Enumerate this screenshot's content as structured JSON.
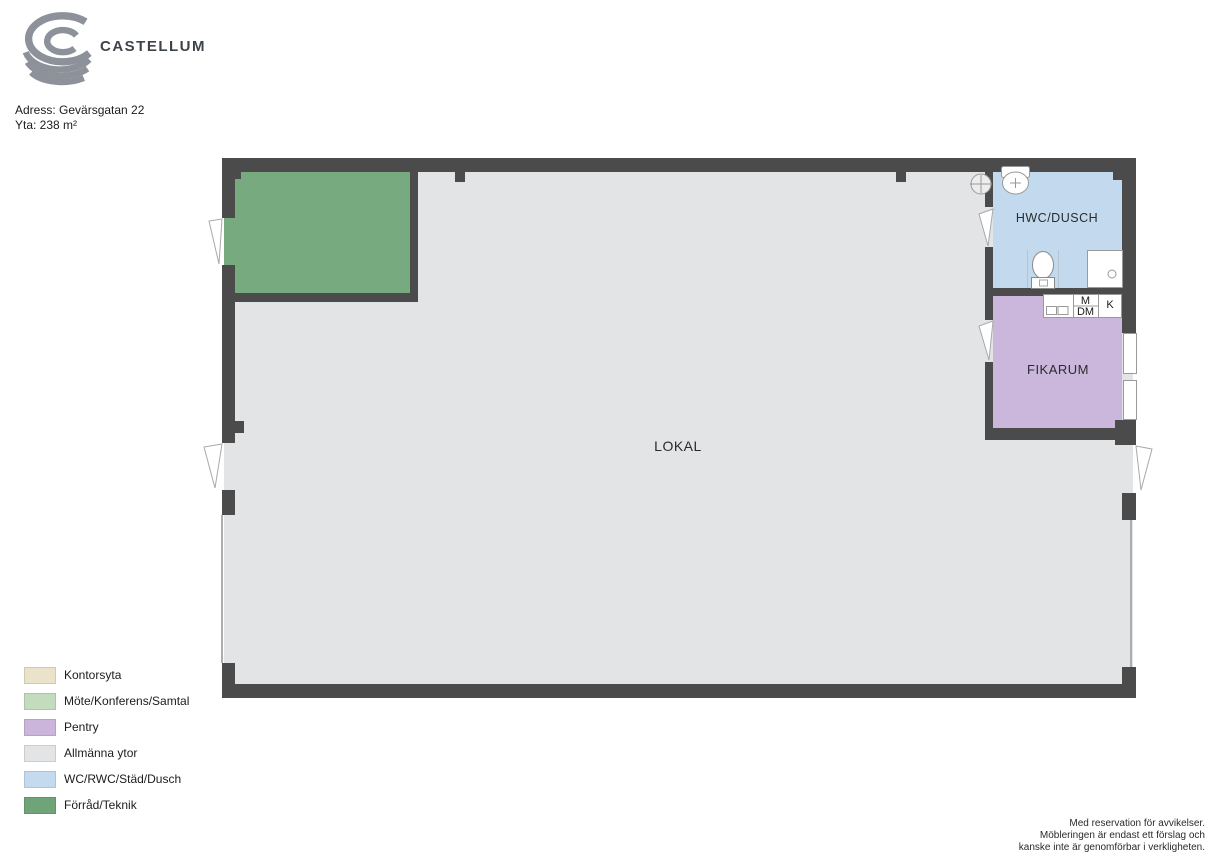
{
  "theme": {
    "wall": "#4b4b4b",
    "floor": "#e3e4e6",
    "forrad": "#78aa80",
    "wc": "#c3daee",
    "pentry": "#ccb7dc",
    "text-dark": "#3e434a"
  },
  "header": {
    "brand": "CASTELLUM",
    "address_label": "Adress: Gevärsgatan 22",
    "area_label": "Yta: 238 m²"
  },
  "plan": {
    "rooms": [
      {
        "name": "lokal",
        "label": "LOKAL"
      },
      {
        "name": "hwc-dusch",
        "label": "HWC/DUSCH"
      },
      {
        "name": "fikarum",
        "label": "FIKARUM"
      },
      {
        "name": "forrad-teknik",
        "label": ""
      }
    ],
    "appliances": [
      {
        "name": "microwave",
        "label": "M"
      },
      {
        "name": "dishwasher",
        "label": "DM"
      },
      {
        "name": "fridge",
        "label": "K"
      }
    ]
  },
  "legend": {
    "items": [
      {
        "label": "Kontorsyta",
        "color": "#eae3c9"
      },
      {
        "label": "Möte/Konferens/Samtal",
        "color": "#c3dcbd"
      },
      {
        "label": "Pentry",
        "color": "#cbb5da"
      },
      {
        "label": "Allmänna ytor",
        "color": "#e3e4e6"
      },
      {
        "label": "WC/RWC/Städ/Dusch",
        "color": "#c4dbef"
      },
      {
        "label": "Förråd/Teknik",
        "color": "#6ea478"
      }
    ]
  },
  "disclaimer": {
    "lines": [
      "Med reservation för avvikelser.",
      "Möbleringen är endast ett förslag och",
      "kanske inte är genomförbar i verkligheten."
    ]
  }
}
